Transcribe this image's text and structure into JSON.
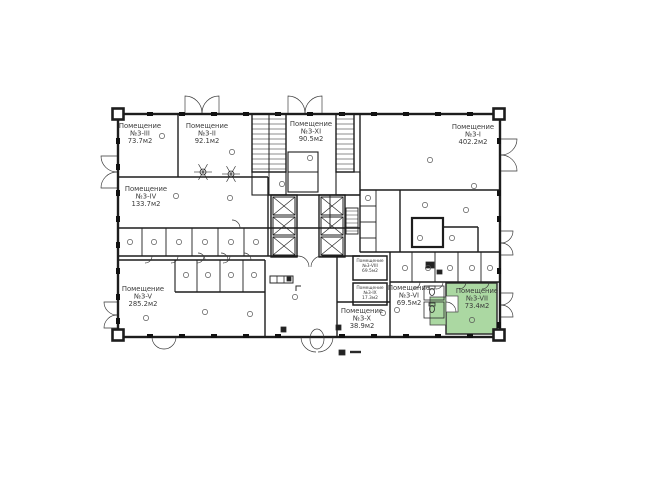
{
  "plan": {
    "type_label": "Помещение",
    "colors": {
      "highlight": "#abd8a2",
      "wall": "#1d1d1d",
      "text": "#3a3a3a",
      "background": "#ffffff"
    },
    "rooms": [
      {
        "id": "3-I",
        "number": "№3-I",
        "area": "402.2м2",
        "highlighted": false
      },
      {
        "id": "3-II",
        "number": "№3-II",
        "area": "92.1м2",
        "highlighted": false
      },
      {
        "id": "3-III",
        "number": "№3-III",
        "area": "73.7м2",
        "highlighted": false
      },
      {
        "id": "3-IV",
        "number": "№3-IV",
        "area": "133.7м2",
        "highlighted": false
      },
      {
        "id": "3-V",
        "number": "№3-V",
        "area": "285.2м2",
        "highlighted": false
      },
      {
        "id": "3-VI",
        "number": "№3-VI",
        "area": "69.5м2",
        "highlighted": false
      },
      {
        "id": "3-VII",
        "number": "№3-VII",
        "area": "73.4м2",
        "highlighted": true
      },
      {
        "id": "3-VIII",
        "number": "№3-VIII",
        "area": "69.5м2",
        "highlighted": false
      },
      {
        "id": "3-IX",
        "number": "№3-IX",
        "area": "17.3м2",
        "highlighted": false
      },
      {
        "id": "3-X",
        "number": "№3-X",
        "area": "38.9м2",
        "highlighted": false
      },
      {
        "id": "3-XI",
        "number": "№3-XI",
        "area": "90.5м2",
        "highlighted": false
      }
    ]
  }
}
